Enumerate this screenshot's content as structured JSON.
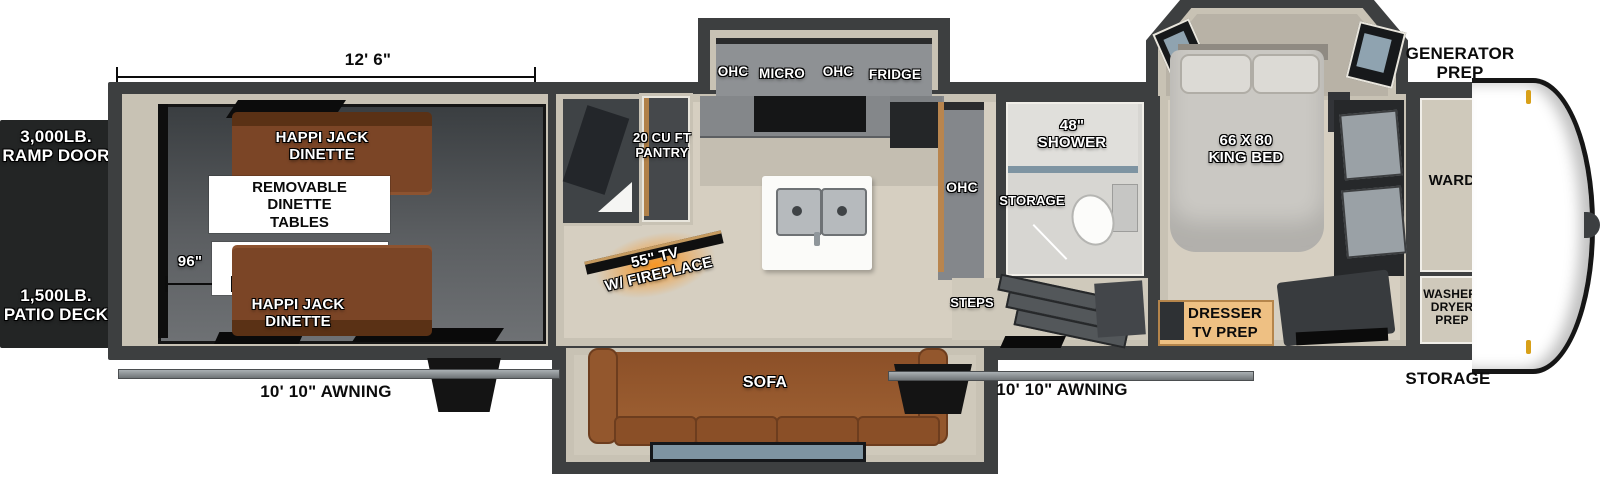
{
  "palette": {
    "wall": "#3d3f40",
    "floor_beige": "#d6cfc1",
    "wall_lining": "#c8c2b4",
    "garage_floor_dark": "#3a3e41",
    "garage_floor_light": "#6e7174",
    "dinette_brown": "#7b4526",
    "sofa_brown": "#9a5c30",
    "fireplace_orange": "#f28b1f",
    "dresser_tan": "#eec083",
    "window_glass": "#7e94a2",
    "front_cap": "#ffffff",
    "marker_light_gold": "#d8a018",
    "label_white": "#ffffff",
    "label_black": "#000000"
  },
  "exterior": {
    "garage_length": "12' 6\"",
    "garage_width": "96\"",
    "ramp_door": "3,000LB.\nRAMP DOOR",
    "patio_deck": "1,500LB.\nPATIO DECK",
    "awning_rear": "10' 10\" AWNING",
    "awning_main": "10' 10\" AWNING",
    "generator_prep": "GENERATOR\nPREP",
    "storage_front": "STORAGE"
  },
  "garage": {
    "dinette_front": "HAPPI JACK\nDINETTE",
    "removable_tables": "REMOVABLE\nDINETTE\nTABLES",
    "queen_bed": "HAPPI JACK\nQUEEN BED\nSYSTEM",
    "dinette_rear": "HAPPI JACK\nDINETTE"
  },
  "kitchen": {
    "pantry": "20 CU FT\nPANTRY",
    "ohc_left": "OHC",
    "micro": "MICRO",
    "ohc_right": "OHC",
    "fridge": "FRIDGE",
    "tv_fireplace": "55\" TV\nW/ FIREPLACE",
    "ohc_island": "OHC",
    "sofa": "SOFA"
  },
  "bathroom": {
    "shower": "48\"\nSHOWER",
    "storage": "STORAGE",
    "steps": "STEPS"
  },
  "bedroom": {
    "king_bed": "66 X 80\nKING BED",
    "ward": "WARD",
    "dresser": "DRESSER\nTV PREP",
    "washer_dryer": "WASHER/\nDRYER\nPREP"
  }
}
